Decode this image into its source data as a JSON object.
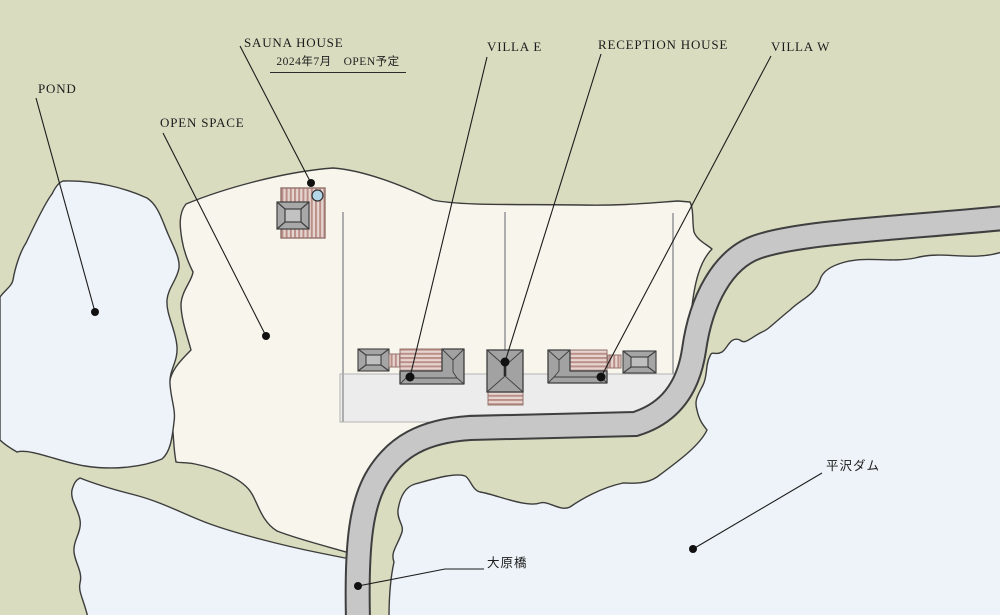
{
  "labels": {
    "pond": "POND",
    "open_space": "OPEN SPACE",
    "sauna_house": "SAUNA HOUSE",
    "sauna_open_date": "2024年7月　OPEN予定",
    "villa_e": "VILLA E",
    "reception_house": "RECEPTION HOUSE",
    "villa_w": "VILLA W",
    "hirasawa_dam": "平沢ダム",
    "ohara_bridge": "大原橋"
  },
  "colors": {
    "terrain_green": "#d9dcbf",
    "site_cream": "#f8f6ec",
    "water_blue": "#edf3f8",
    "road_gray": "#c7c7c7",
    "road_casing": "#3f3f3f",
    "pad_gray": "#ececec",
    "building_gray": "#a2a2a2",
    "roof_top_gray": "#c2c2c2",
    "deck_pink_stripe": "#bb8f88",
    "deck_pink_base": "#e6d6d1",
    "bath_blue": "#b3d6e9",
    "outline_dark": "#3c3c3c"
  }
}
